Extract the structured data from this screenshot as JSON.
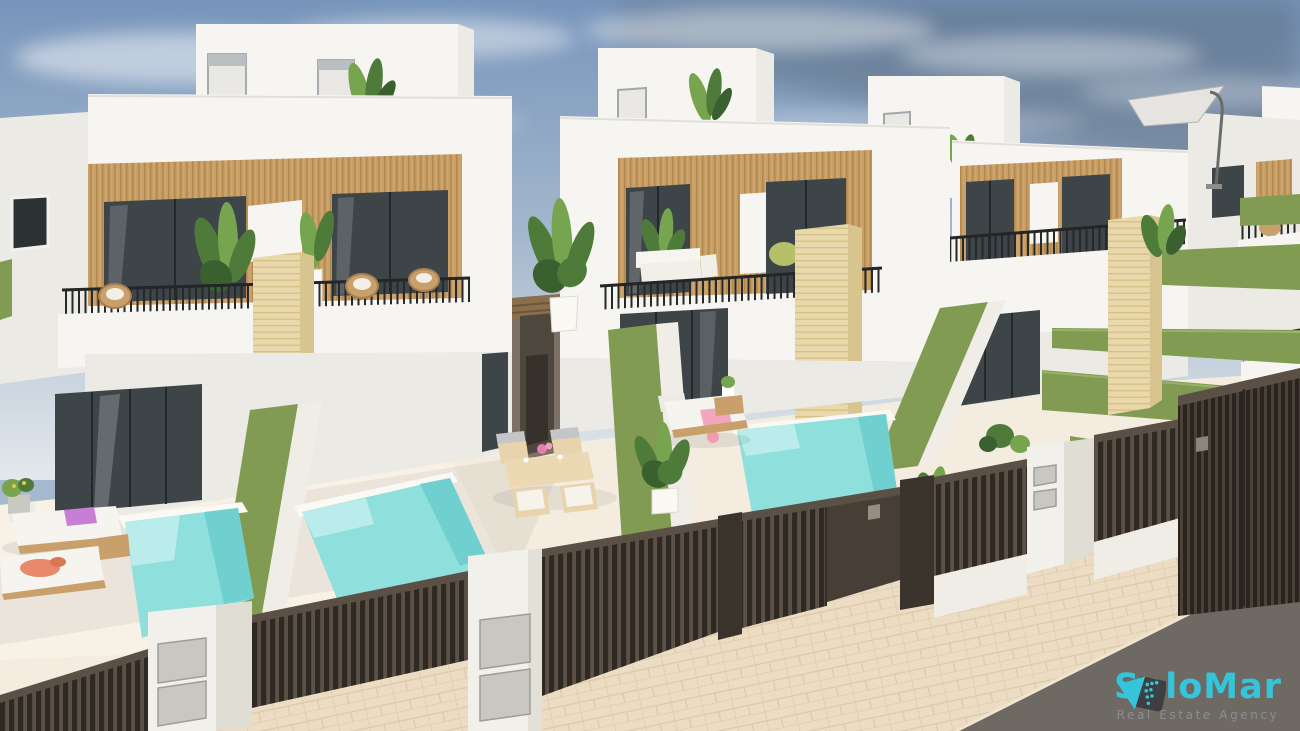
{
  "logo": {
    "brand": "SoloMar",
    "tagline": "Real Estate Agency"
  },
  "scene": {
    "alt": "3D architectural render of a row of modern white two-storey townhouses with wood-panel accents, balconies with black railings, travertine pillars, green hedge walls, private turquoise pools, sun loungers, dark brown slatted gates and a beige tiled sidewalk under a blue sky"
  },
  "colors": {
    "brand_cyan": "#35c4d9",
    "tagline_gray": "#8b8e92",
    "sky_top": "#7795bb",
    "sky_mid": "#a5b8cd",
    "sky_horizon": "#e3e8ec",
    "wall_white": "#f6f5f1",
    "wall_shade": "#eceae4",
    "wood_tan": "#c79e66",
    "window_glass": "#3e4549",
    "hedge_green": "#819b52",
    "pool_turquoise": "#8fdfdd",
    "pool_deep": "#6fd0cf",
    "stone_beige": "#e9d8ac",
    "fence_brown": "#473f36",
    "post_white": "#f2f0ea",
    "paving_beige": "#ecdcc3",
    "patio_cream": "#f3ecdf",
    "road_gray": "#6f6963",
    "field_green": "#a8c160",
    "plant_green": "#4e7a3a",
    "furniture_wood": "#c9a06b",
    "railing_black": "#26282a"
  }
}
